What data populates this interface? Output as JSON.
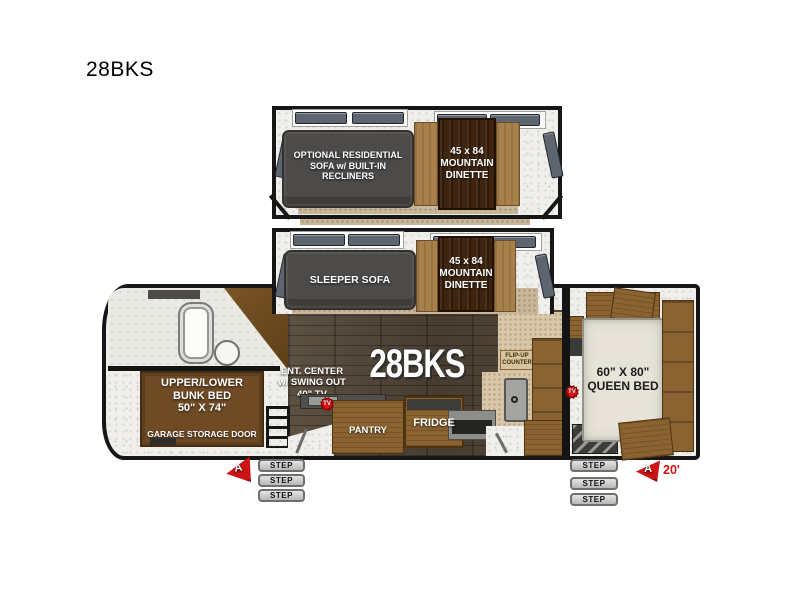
{
  "title": "28BKS",
  "slide_top": {
    "sofa_label": "OPTIONAL RESIDENTIAL\nSOFA w/ BUILT-IN\nRECLINERS",
    "dinette_label": "45 x 84\nMOUNTAIN\nDINETTE"
  },
  "slide_mid": {
    "sofa_label": "SLEEPER SOFA",
    "dinette_label": "45 x 84\nMOUNTAIN\nDINETTE"
  },
  "main": {
    "model_label": "28BKS",
    "ent_center_label": "ENT. CENTER\nw/ SWING OUT\n40\" TV",
    "bunk_label": "UPPER/LOWER\nBUNK BED\n50\" X 74\"",
    "garage_label": "GARAGE STORAGE DOOR",
    "pantry_label": "PANTRY",
    "fridge_label": "FRIDGE",
    "flip_up_label": "FLIP-UP\nCOUNTER",
    "queen_label": "60\" X 80\"\nQUEEN BED"
  },
  "badges": {
    "tv": "TV"
  },
  "steps": {
    "label": "STEP"
  },
  "awning": {
    "marker": "A",
    "length": "20'"
  },
  "colors": {
    "wall": "#141414",
    "sofa": "#4d4b49",
    "bench": "#a8804c",
    "table_wood": "#3f250f",
    "cabinet_wood": "#8a6331",
    "bunk_brown": "#6f4b25",
    "floor_plank": "#584c3e",
    "carpet": "#c9b79b",
    "bed": "#e7e3d8",
    "marker_red": "#cd1414",
    "step_gray": "#c9c9c7"
  }
}
